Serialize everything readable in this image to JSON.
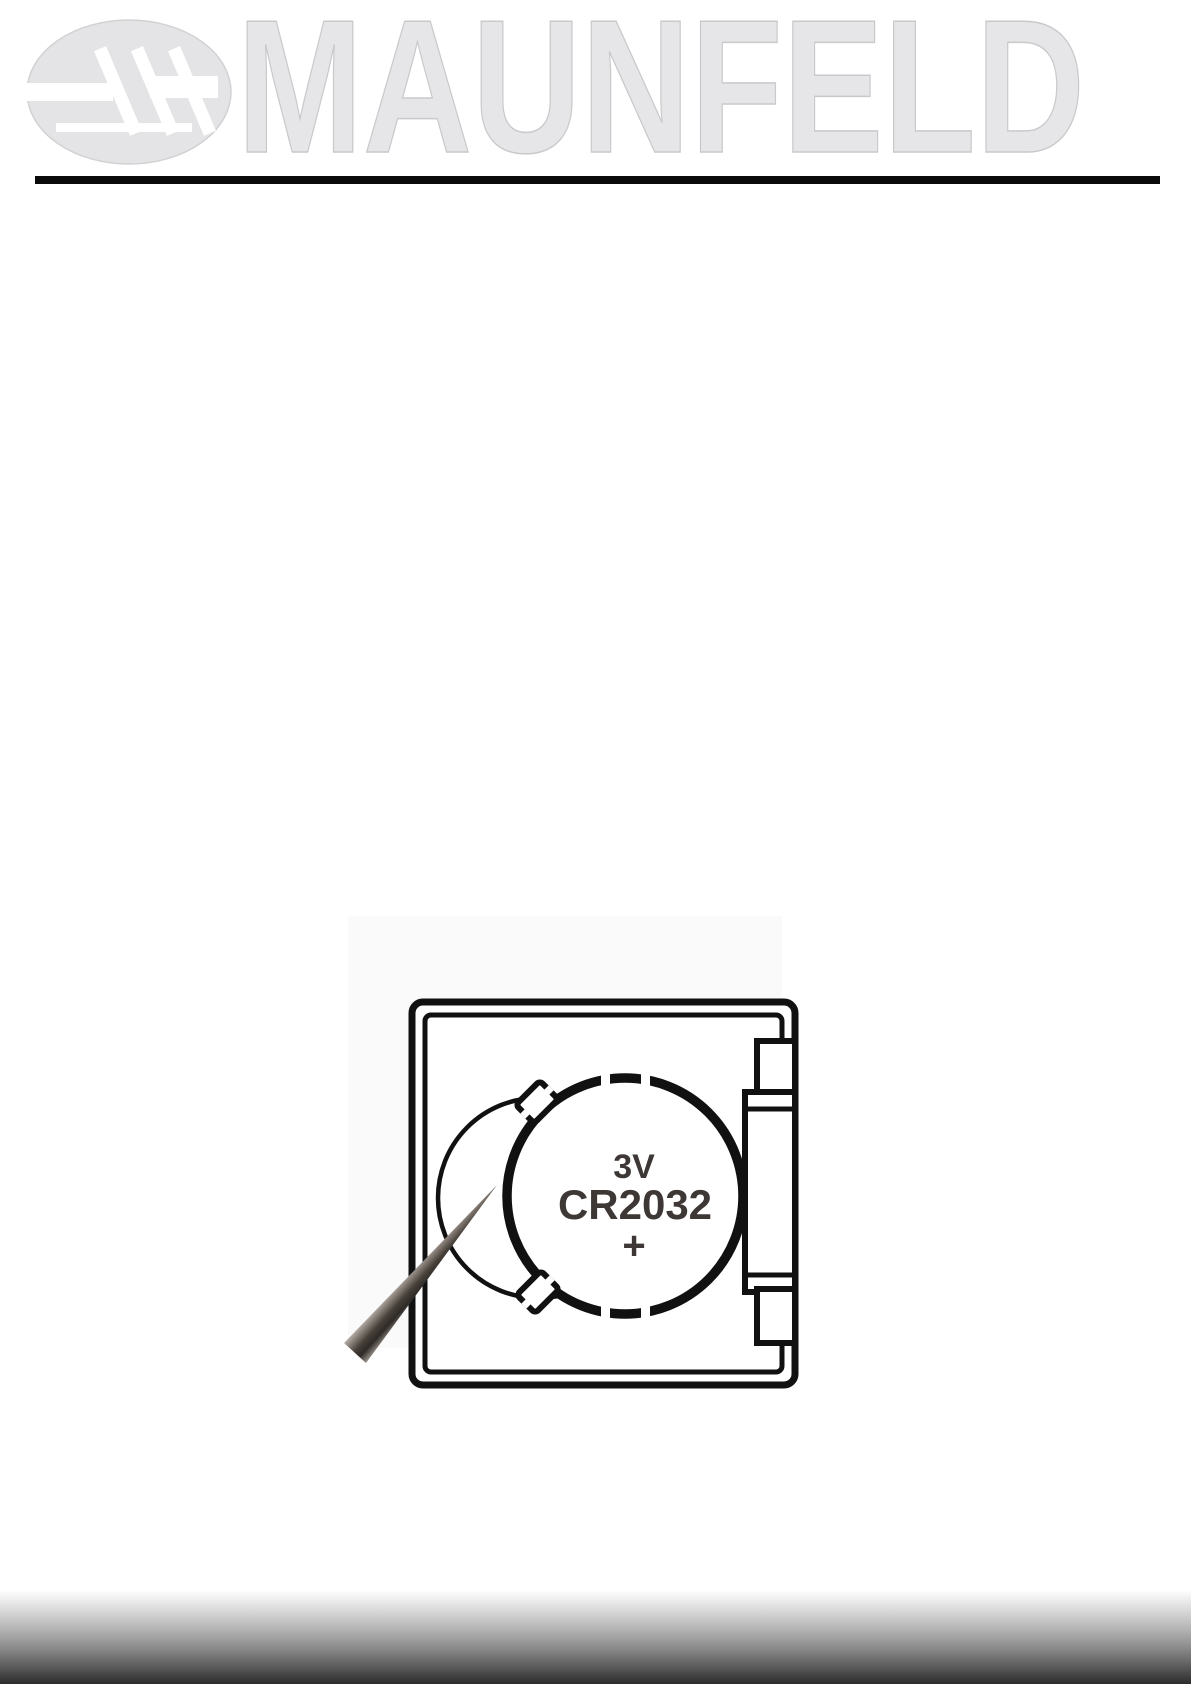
{
  "page": {
    "background_color": "#ffffff"
  },
  "header": {
    "brand_name": "MAUNFELD",
    "wordmark_fill_color": "#e6e6e8",
    "wordmark_outline_color": "#c9c9cb",
    "logo_mark_color": "#e4e4e6",
    "divider_color": "#0a0a0a"
  },
  "figure": {
    "outline_color": "#111111",
    "label_color": "#3d3835",
    "battery": {
      "voltage_label": "3V",
      "model_label": "CR2032",
      "polarity_label": "+"
    }
  },
  "footer": {
    "gradient_top_color": "#ffffff",
    "gradient_bottom_color": "#2b2b2b"
  }
}
